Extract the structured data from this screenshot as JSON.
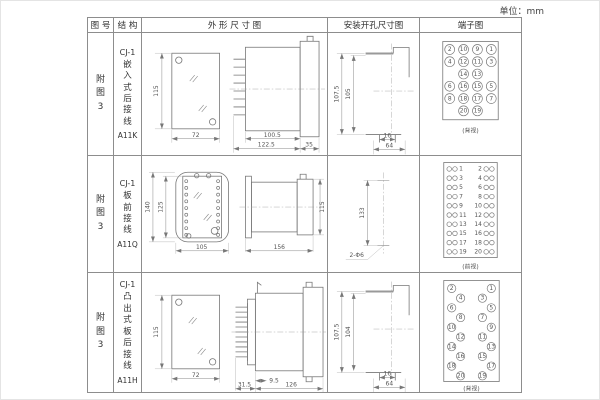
{
  "unit_label": "单位：mm",
  "header": {
    "col_fig_no": "图 号",
    "col_structure": "结 构",
    "col_outline": "外 形 尺 寸 图",
    "col_mounting": "安装开孔尺寸图",
    "col_terminal": "端子图"
  },
  "rows": [
    {
      "fig_no": "附图3",
      "model": "CJ-1",
      "mount_type": "嵌入式后接线",
      "code": "A11K",
      "outline": {
        "front_height": "115",
        "front_width": "72",
        "side_body": "100.5",
        "side_total": "122.5",
        "side_flange": "35"
      },
      "mounting": {
        "outer_height": "107.5",
        "inner_height": "105",
        "slot_width": "16",
        "hole_span": "64"
      },
      "terminal": {
        "view_label": "(背视)"
      }
    },
    {
      "fig_no": "附图3",
      "model": "CJ-1",
      "mount_type": "板前接线",
      "code": "A11Q",
      "outline": {
        "front_outer_height": "140",
        "front_inner_height": "125",
        "front_width": "105",
        "side_length": "156",
        "side_height": "115"
      },
      "mounting": {
        "hole_spacing": "133",
        "hole_callout": "2-Φ6"
      },
      "terminal": {
        "view_label": "(前视)"
      }
    },
    {
      "fig_no": "附图3",
      "model": "CJ-1",
      "mount_type": "凸出式板后接线",
      "code": "A11H",
      "outline": {
        "front_height": "115",
        "front_width": "72",
        "side_pin_len": "9.5",
        "side_base": "31.5",
        "side_length": "126"
      },
      "mounting": {
        "outer_height": "107.5",
        "inner_height": "104",
        "slot_width": "16",
        "hole_span": "64"
      },
      "terminal": {
        "view_label": "(背视)"
      }
    }
  ],
  "terminals": {
    "a11k_grid": [
      [
        "2",
        "10",
        "9",
        "1"
      ],
      [
        "4",
        "12",
        "11",
        "3"
      ],
      [
        "",
        "14",
        "13",
        ""
      ],
      [
        "6",
        "16",
        "15",
        "5"
      ],
      [
        "8",
        "18",
        "17",
        "7"
      ],
      [
        "",
        "20",
        "19",
        ""
      ]
    ],
    "a11q_left": [
      "1",
      "3",
      "5",
      "7",
      "9",
      "11",
      "13",
      "15",
      "17",
      "19"
    ],
    "a11q_right": [
      "2",
      "4",
      "6",
      "8",
      "10",
      "12",
      "14",
      "16",
      "18",
      "20"
    ],
    "a11h_left": [
      "2",
      "4",
      "6",
      "8",
      "10",
      "12",
      "14",
      "16",
      "18",
      "20"
    ],
    "a11h_right": [
      "1",
      "3",
      "5",
      "7",
      "9",
      "11",
      "13",
      "15",
      "17",
      "19"
    ]
  },
  "colors": {
    "line": "#777777",
    "border": "#8d8d8d",
    "text": "#333333"
  }
}
